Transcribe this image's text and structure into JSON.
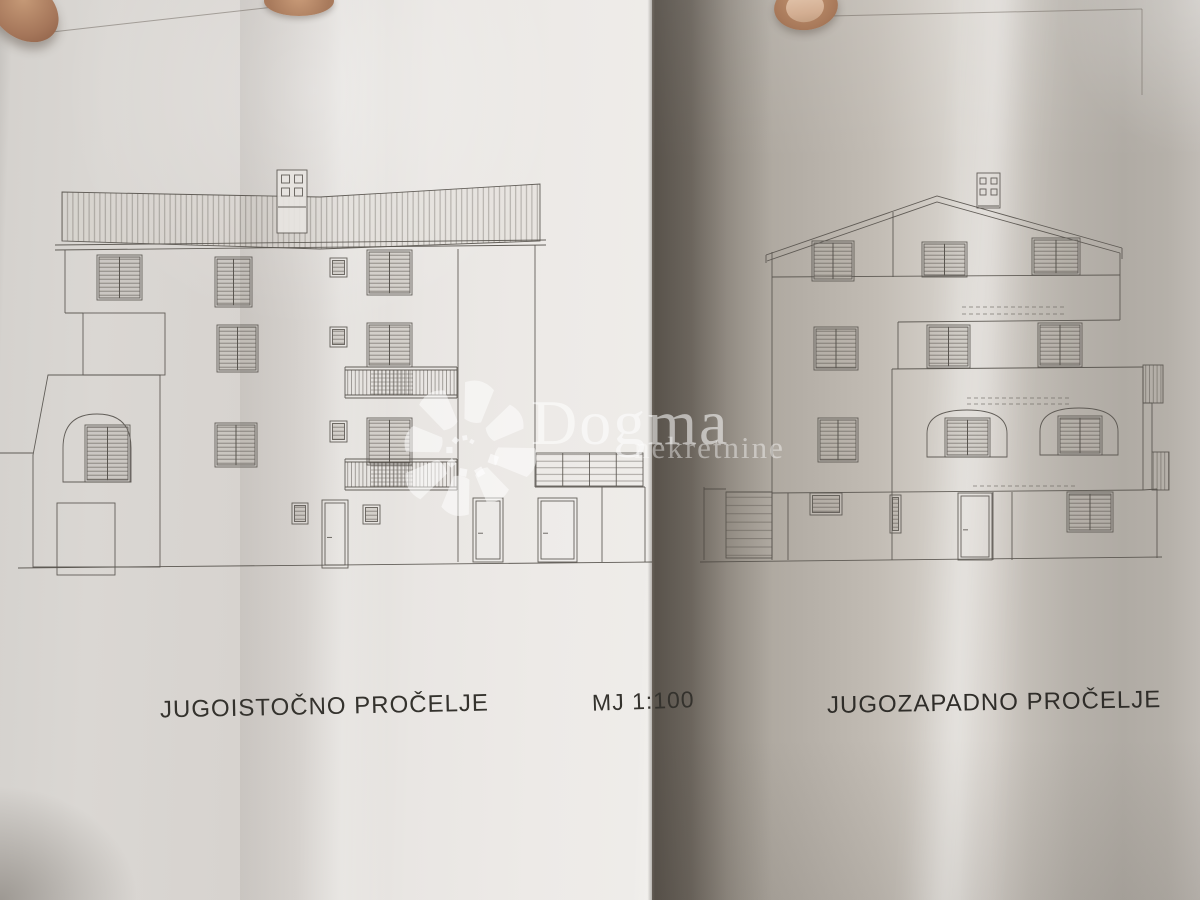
{
  "photo": {
    "type": "architectural elevation blueprints held by hand",
    "labels": {
      "left_elevation_title": "JUGOISTOČNO PROČELJE",
      "scale_note": "MJ 1:100",
      "right_elevation_title": "JUGOZAPADNO PROČELJE"
    },
    "watermark": {
      "brand": "Dogma",
      "subtitle": "nekretnine"
    },
    "colors": {
      "paper_light": "#ebe8e5",
      "paper_shaded": "#b0aba4",
      "gap_shadow": "#5f584f",
      "ink": "#57534d",
      "skin": "#b9895f"
    }
  }
}
